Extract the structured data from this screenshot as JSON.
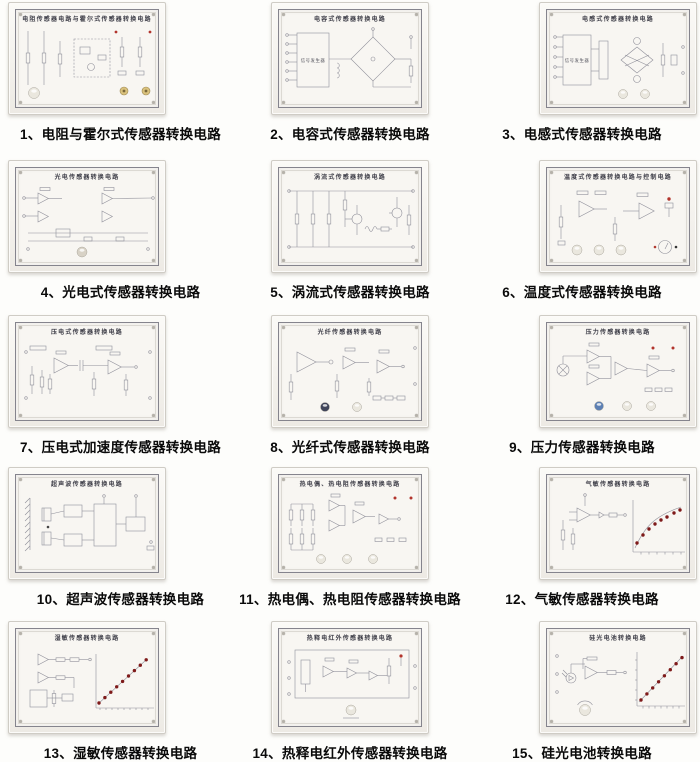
{
  "page": {
    "background": "#fdfdfb"
  },
  "colors": {
    "schematic_stroke": "#90909a",
    "led_dark_red": "#7e1a1a",
    "led_bright_red": "#b2342c",
    "knob_white": "#eae7de",
    "knob_dark": "#40455a",
    "knob_blue": "#5d80b4",
    "jack_gold": "#d9c17c"
  },
  "panels": [
    {
      "caption": "1、电阻与霍尔式传感器转换电路",
      "title": "电阻传感器电路与霍尔式传感器转换电路",
      "art": "hall-resistor"
    },
    {
      "caption": "2、电容式传感器转换电路",
      "title": "电容式传感器转换电路",
      "art": "capacitive-bridge",
      "box_label": "信号发生器"
    },
    {
      "caption": "3、电感式传感器转换电路",
      "title": "电感式传感器转换电路",
      "art": "inductive-bridge",
      "box_label": "信号发生器"
    },
    {
      "caption": "4、光电式传感器转换电路",
      "title": "光电传感器转换电路",
      "art": "photoelectric"
    },
    {
      "caption": "5、涡流式传感器转换电路",
      "title": "涡流式传感器转换电路",
      "art": "eddy-current"
    },
    {
      "caption": "6、温度式传感器转换电路",
      "title": "温度式传感器转换电路与控制电路",
      "art": "temperature"
    },
    {
      "caption": "7、压电式加速度传感器转换电路",
      "title": "压电式传感器转换电路",
      "art": "piezo"
    },
    {
      "caption": "8、光纤式传感器转换电路",
      "title": "光纤传感器转换电路",
      "art": "fiber"
    },
    {
      "caption": "9、压力传感器转换电路",
      "title": "压力传感器转换电路",
      "art": "pressure"
    },
    {
      "caption": "10、超声波传感器转换电路",
      "title": "超声波传感器转换电路",
      "art": "ultrasonic"
    },
    {
      "caption": "11、热电偶、热电阻传感器转换电路",
      "title": "热电偶、热电阻传感器转换电路",
      "art": "thermocouple"
    },
    {
      "caption": "12、气敏传感器转换电路",
      "title": "气敏传感器转换电路",
      "art": "gas"
    },
    {
      "caption": "13、湿敏传感器转换电路",
      "title": "湿敏传感器转换电路",
      "art": "humidity"
    },
    {
      "caption": "14、热释电红外传感器转换电路",
      "title": "热释电红外传感器转换电路",
      "art": "pyroelectric"
    },
    {
      "caption": "15、硅光电池转换电路",
      "title": "硅光电池转换电路",
      "art": "solar-cell"
    }
  ]
}
